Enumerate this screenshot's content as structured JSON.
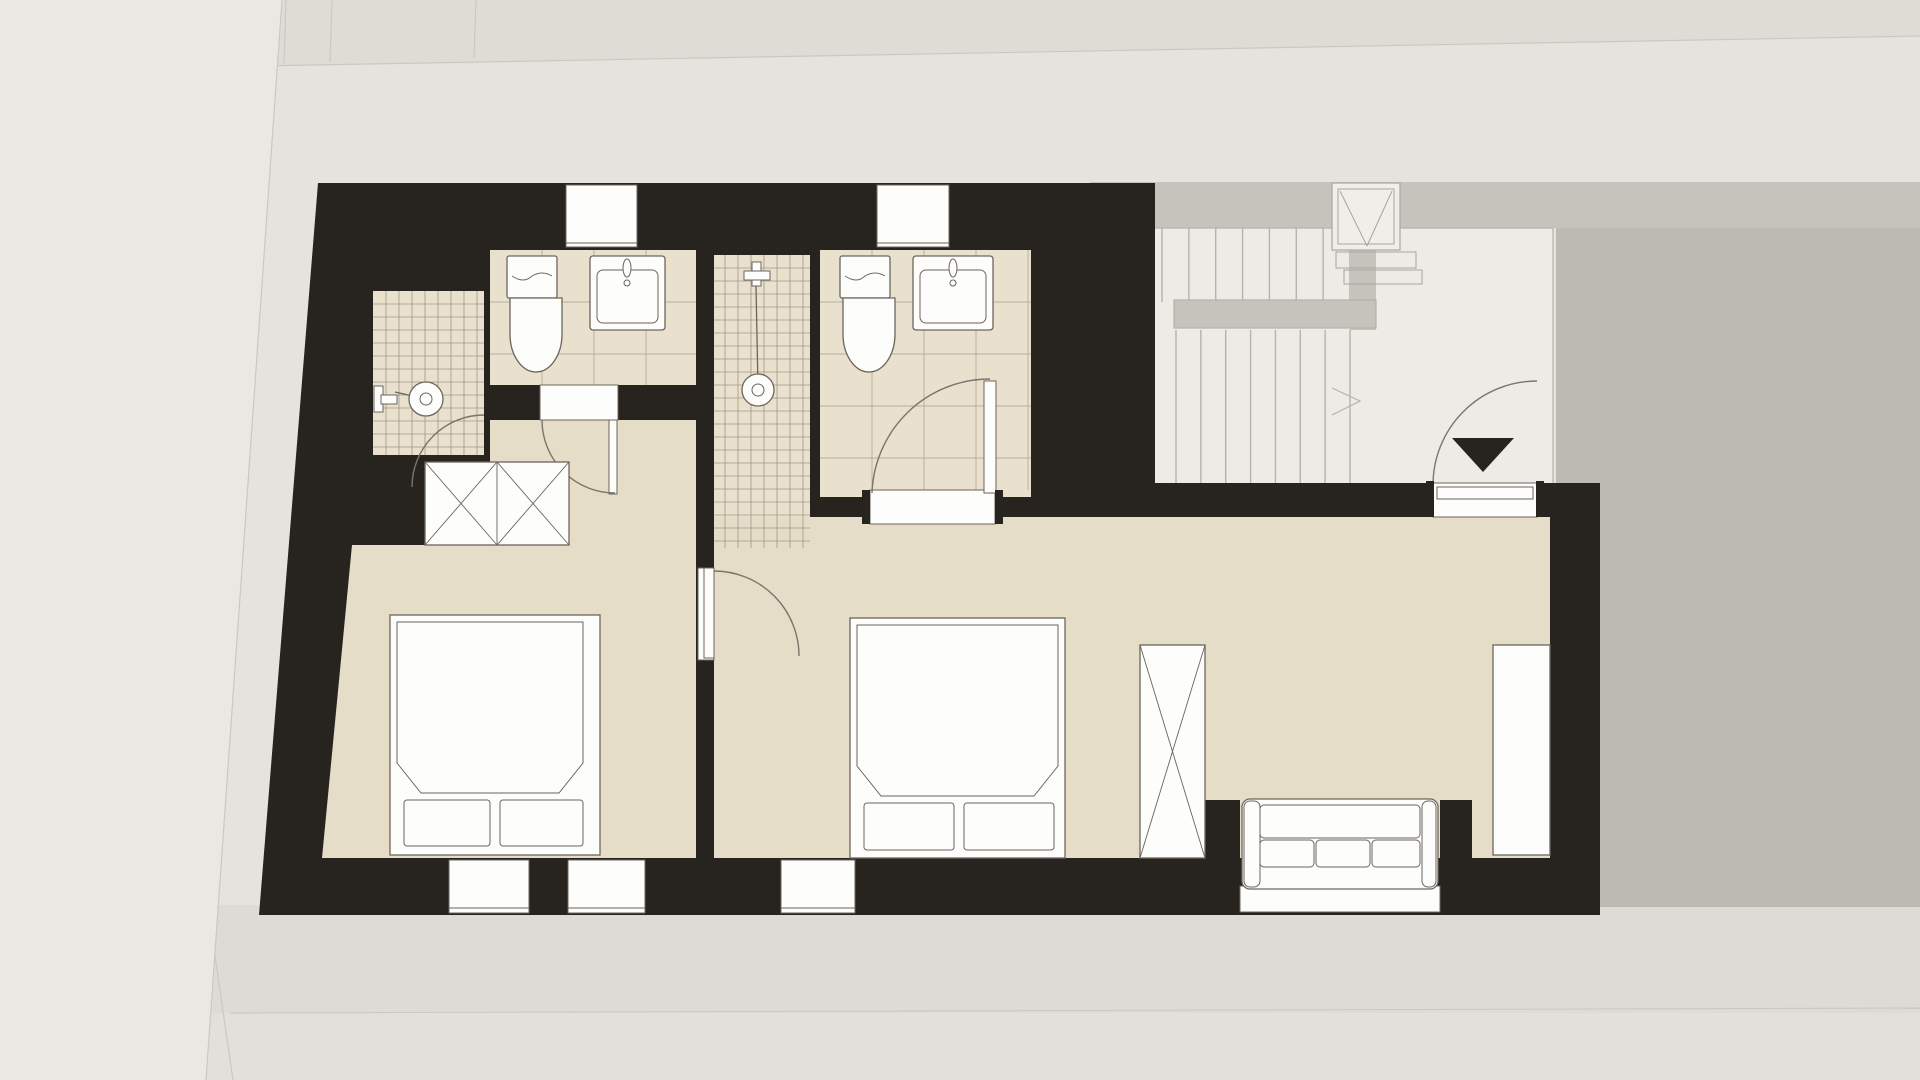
{
  "title": "apartment-upper-floor-plan",
  "palette": {
    "bg": "#e6e3de",
    "bgTop": "#dfdcd6",
    "bgLeft": "#ebe8e3",
    "terrace": "#bdbab4",
    "band": "#c6c3bc",
    "hall": "#edebe6",
    "ground1": "#dedbd6",
    "ground2": "#e3e0db",
    "wall": "#272420",
    "floor": "#e6ddc9",
    "bathFloor": "#e9e0cd",
    "fixture": "#fdfdfc",
    "line": "#6b655c",
    "tile": "#8d8678",
    "tread": "#b5b2aa",
    "rail": "#c6c3bc",
    "arc": "#7a756d",
    "seam": "#cbc8c2"
  },
  "plan": {
    "rooms": [
      {
        "name": "bathroom-1",
        "fixtures": [
          "toilet",
          "washbasin",
          "shower"
        ]
      },
      {
        "name": "bathroom-2",
        "fixtures": [
          "toilet",
          "washbasin",
          "shower"
        ]
      },
      {
        "name": "bedroom-1",
        "furniture": [
          "double-bed",
          "crossed-wardrobe"
        ]
      },
      {
        "name": "bedroom-2-living",
        "furniture": [
          "double-bed",
          "crossed-wardrobe",
          "sofa",
          "closet"
        ]
      },
      {
        "name": "stair-hall",
        "features": [
          "u-stair",
          "landing-rail",
          "shaft",
          "entry-door",
          "entrance-marker"
        ]
      }
    ],
    "windows_top": 2,
    "windows_bottom": 3,
    "french_window": 1,
    "doors": [
      "bathroom-1-door",
      "bathroom-2-door",
      "bedroom-connecting-door",
      "entry-door"
    ],
    "grids": [
      {
        "id": "grid-shower-1",
        "x": 373,
        "y": 291,
        "w": 111,
        "h": 164,
        "pitch": 13
      },
      {
        "id": "grid-shower-2",
        "x": 712,
        "y": 255,
        "w": 98,
        "h": 293,
        "pitch": 13
      },
      {
        "id": "grid-bath-1",
        "x": 490,
        "y": 250,
        "w": 206,
        "h": 135,
        "pitch": 52
      },
      {
        "id": "grid-bath-2",
        "x": 820,
        "y": 250,
        "w": 211,
        "h": 240,
        "pitch": 52
      }
    ],
    "stairs": {
      "upper_flight": {
        "id": "treads-upper",
        "x": 1162,
        "y": 228,
        "w": 188,
        "h": 74,
        "count": 7
      },
      "lower_flight": {
        "id": "treads-lower",
        "x": 1176,
        "y": 330,
        "w": 174,
        "h": 167,
        "count": 7
      }
    }
  }
}
